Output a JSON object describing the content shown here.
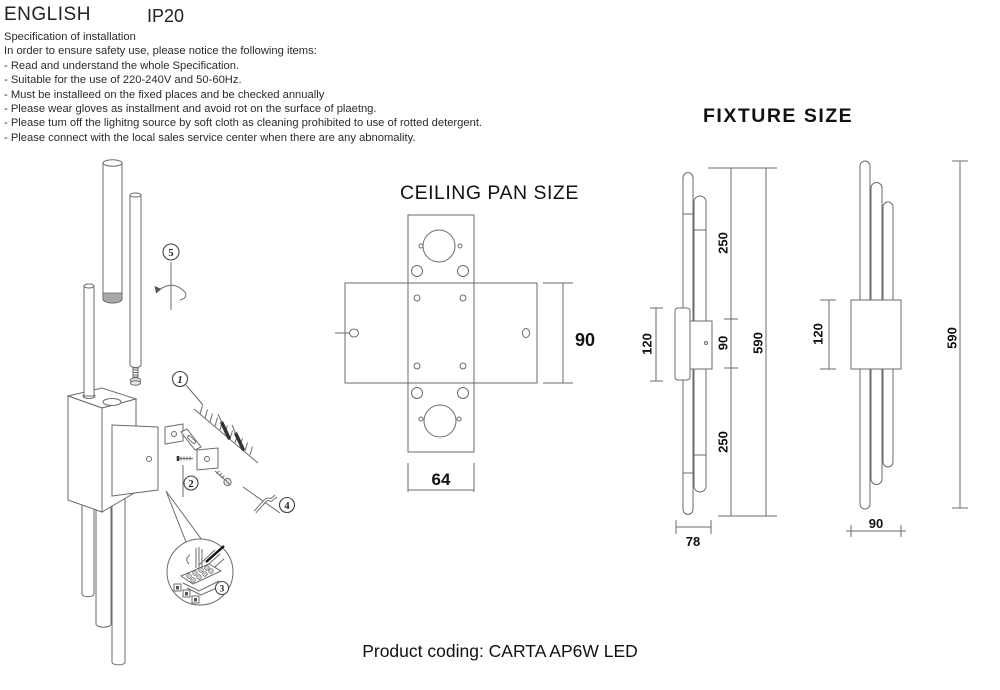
{
  "header": {
    "language": "ENGLISH",
    "ip_rating": "IP20"
  },
  "spec": {
    "title": "Specification of installation",
    "intro": "In order to ensure safety use, please notice the following items:",
    "items": [
      "- Read and understand the whole Specification.",
      "- Suitable for the use of 220-240V and 50-60Hz.",
      "- Must be installeed on the fixed places and be checked annually",
      "- Please wear gloves as installment and avoid rot on the surface of plaetng.",
      "- Please tum off the lighitng source by soft cloth as cleaning prohibited to use of rotted detergent.",
      "- Please connect with the local sales service center when there are any abnomality."
    ]
  },
  "ceiling_pan": {
    "title": "CEILING PAN SIZE",
    "dim_height": "90",
    "dim_width": "64"
  },
  "fixture": {
    "title": "FIXTURE SIZE",
    "side_view": {
      "bracket": "120",
      "upper": "250",
      "middle": "90",
      "lower": "250",
      "overall": "590",
      "depth": "78"
    },
    "front_view": {
      "bracket": "120",
      "overall": "590",
      "width": "90"
    }
  },
  "installation": {
    "steps": {
      "s1": "1",
      "s2": "2",
      "s3": "3",
      "s4": "4",
      "s5": "5"
    }
  },
  "footer": {
    "product_coding": "Product coding: CARTA AP6W LED"
  },
  "colors": {
    "ink": "#1a1a1a",
    "line": "#6b6b6b",
    "background": "#ffffff"
  }
}
